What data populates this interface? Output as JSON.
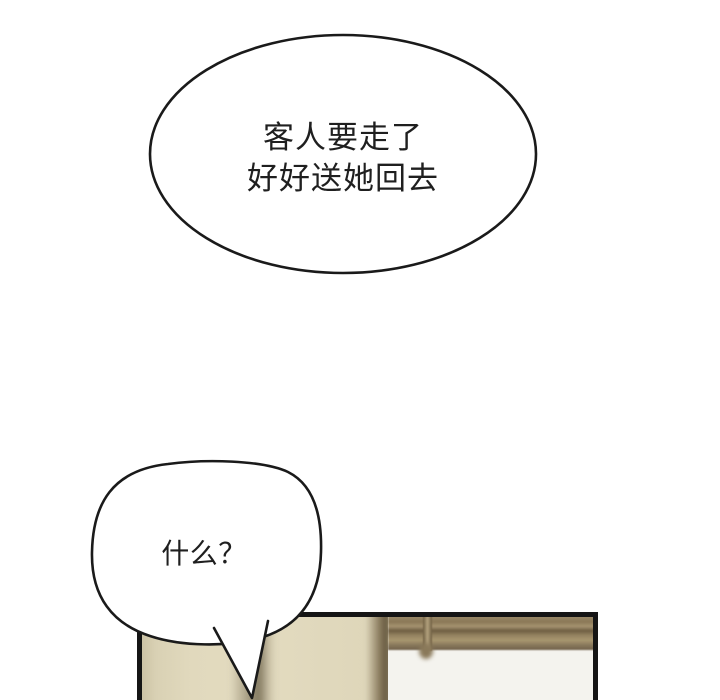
{
  "page": {
    "background_color": "#ffffff",
    "type_label": "webtoon-comic-panel"
  },
  "bubble_top": {
    "line1": "客人要走了",
    "line2": "好好送她回去"
  },
  "bubble_bottom": {
    "text": "什么？"
  },
  "colors": {
    "bubble_fill": "#ffffff",
    "bubble_outline": "#1a1a1a",
    "text": "#1f1f1f",
    "panel_border": "#151515",
    "wall_beige": "#e1d9bd",
    "wall_shadow_brown": "#5f5138",
    "window_curtain_white": "#f4f3ee",
    "blinds_brown": "#9c8a6a"
  }
}
